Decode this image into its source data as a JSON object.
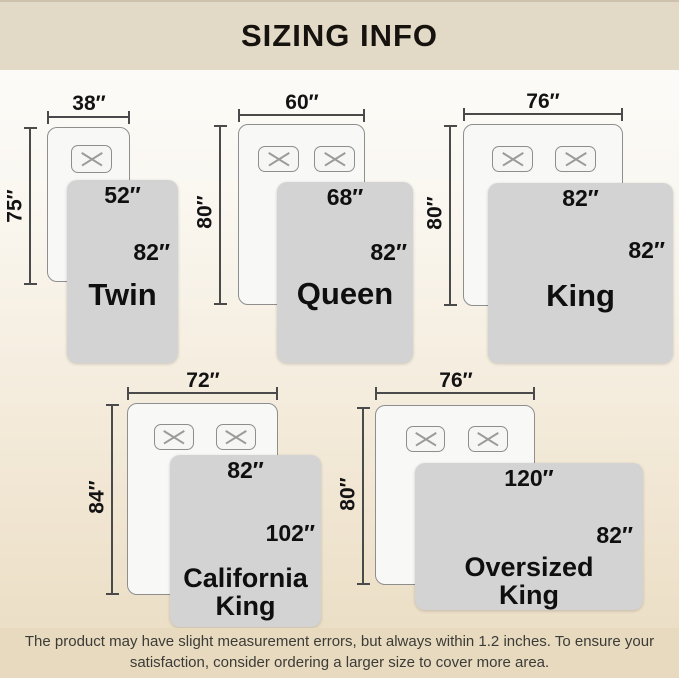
{
  "header": {
    "title": "SIZING INFO"
  },
  "footer": {
    "line1": "The product may have slight measurement errors, but always within 1.2 inches. To ensure your",
    "line2": "satisfaction, consider ordering a larger size to cover more area."
  },
  "beds": [
    {
      "name": [
        "Twin"
      ],
      "mattress_width": "38″",
      "mattress_length": "75″",
      "blanket_width": "52″",
      "blanket_length": "82″",
      "pillows": 1
    },
    {
      "name": [
        "Queen"
      ],
      "mattress_width": "60″",
      "mattress_length": "80″",
      "blanket_width": "68″",
      "blanket_length": "82″",
      "pillows": 2
    },
    {
      "name": [
        "King"
      ],
      "mattress_width": "76″",
      "mattress_length": "80″",
      "blanket_width": "82″",
      "blanket_length": "82″",
      "pillows": 2
    },
    {
      "name": [
        "California",
        "King"
      ],
      "mattress_width": "72″",
      "mattress_length": "84″",
      "blanket_width": "82″",
      "blanket_length": "102″",
      "pillows": 2
    },
    {
      "name": [
        "Oversized",
        "King"
      ],
      "mattress_width": "76″",
      "mattress_length": "80″",
      "blanket_width": "120″",
      "blanket_length": "82″",
      "pillows": 2
    }
  ],
  "colors": {
    "header_band": "#e3d9c7",
    "footer_band": "#e7dabf",
    "background_top": "#fdfdfc",
    "background_bottom": "#eadcc2",
    "blanket": "#d3d3d3",
    "mattress": "#f8f8f7",
    "measure_line": "#4a4a4a",
    "text": "#0f0f0f"
  }
}
